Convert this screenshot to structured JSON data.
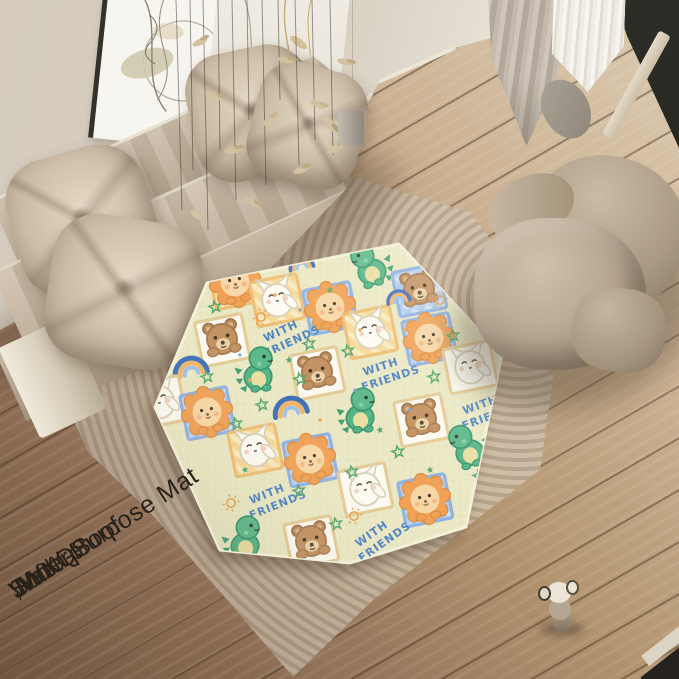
{
  "watermark": {
    "lines": [
      "JWXQS",
      ",Multi-Purpose Mat",
      "Soft",
      "Waterproof"
    ],
    "color": "#29221a"
  },
  "mat": {
    "pattern_text": [
      "WITH",
      "FRIENDS"
    ],
    "shape": "hexagon",
    "colors": {
      "background": "#eae8c3",
      "edge_highlight": "#f3f1d8",
      "text_blue": "#4d83c3",
      "lion_mane": "#f0a155",
      "lion_face": "#f8d7a6",
      "bear_brown": "#c29161",
      "cat_white": "#fdfbf2",
      "dino_green": "#55b385",
      "frame_tan": "#f6d998",
      "frame_blue": "#b9d1ef",
      "star_green": "#58a96e",
      "sun_orange": "#e89a4e"
    },
    "tiles": [
      {
        "t": "lion",
        "f": "tan",
        "x": 235,
        "y": 282
      },
      {
        "t": "cat",
        "f": "tan",
        "x": 277,
        "y": 299
      },
      {
        "t": "lion",
        "f": "blue",
        "x": 330,
        "y": 307
      },
      {
        "t": "dino",
        "x": 368,
        "y": 265,
        "fl": 1
      },
      {
        "t": "bear",
        "f": "blue",
        "x": 419,
        "y": 289
      },
      {
        "t": "bear",
        "f": "white",
        "x": 222,
        "y": 339
      },
      {
        "t": "wf",
        "x": 284,
        "y": 338,
        "r": -25
      },
      {
        "t": "cat",
        "f": "tan",
        "x": 370,
        "y": 331
      },
      {
        "t": "lion",
        "f": "blue",
        "x": 429,
        "y": 338
      },
      {
        "t": "rainbow",
        "x": 301,
        "y": 263,
        "s": 0.9
      },
      {
        "t": "rainbow",
        "x": 190,
        "y": 367
      },
      {
        "t": "dino",
        "x": 259,
        "y": 369
      },
      {
        "t": "bear",
        "f": "white",
        "x": 317,
        "y": 372
      },
      {
        "t": "wf",
        "x": 383,
        "y": 374,
        "r": -18
      },
      {
        "t": "cat",
        "f": "white",
        "x": 470,
        "y": 366
      },
      {
        "t": "rainbow",
        "x": 398,
        "y": 297,
        "s": 0.85
      },
      {
        "t": "cat",
        "f": "white",
        "x": 159,
        "y": 401
      },
      {
        "t": "lion",
        "f": "blue",
        "x": 207,
        "y": 412
      },
      {
        "t": "rainbow",
        "x": 290,
        "y": 407
      },
      {
        "t": "dino",
        "x": 361,
        "y": 410
      },
      {
        "t": "bear",
        "f": "white",
        "x": 421,
        "y": 419
      },
      {
        "t": "wf",
        "x": 483,
        "y": 412,
        "r": -20
      },
      {
        "t": "cat",
        "f": "tan",
        "x": 255,
        "y": 449
      },
      {
        "t": "lion",
        "f": "blue",
        "x": 310,
        "y": 459
      },
      {
        "t": "cat",
        "f": "white",
        "x": 365,
        "y": 488
      },
      {
        "t": "lion",
        "f": "blue",
        "x": 425,
        "y": 499
      },
      {
        "t": "dino",
        "x": 466,
        "y": 446,
        "fl": 1
      },
      {
        "t": "wf",
        "x": 270,
        "y": 501,
        "r": -22
      },
      {
        "t": "dino",
        "x": 246,
        "y": 538
      },
      {
        "t": "bear",
        "f": "white",
        "x": 311,
        "y": 541
      },
      {
        "t": "wf",
        "x": 376,
        "y": 540,
        "r": -35
      }
    ],
    "sprinkles": [
      {
        "t": "star",
        "x": 256,
        "y": 252
      },
      {
        "t": "star",
        "x": 215,
        "y": 307
      },
      {
        "t": "star",
        "x": 309,
        "y": 344
      },
      {
        "t": "star",
        "x": 348,
        "y": 351
      },
      {
        "t": "star",
        "x": 300,
        "y": 379
      },
      {
        "t": "star",
        "x": 207,
        "y": 377
      },
      {
        "t": "star",
        "x": 236,
        "y": 424
      },
      {
        "t": "star",
        "x": 352,
        "y": 472
      },
      {
        "t": "star",
        "x": 299,
        "y": 491
      },
      {
        "t": "star",
        "x": 434,
        "y": 377
      },
      {
        "t": "star",
        "x": 453,
        "y": 336
      },
      {
        "t": "star",
        "x": 479,
        "y": 476
      },
      {
        "t": "star",
        "x": 336,
        "y": 524
      },
      {
        "t": "star",
        "x": 398,
        "y": 452
      },
      {
        "t": "star",
        "x": 262,
        "y": 405
      },
      {
        "t": "sun",
        "x": 261,
        "y": 317
      },
      {
        "t": "sun",
        "x": 231,
        "y": 503
      },
      {
        "t": "sun",
        "x": 354,
        "y": 516
      },
      {
        "t": "sun",
        "x": 440,
        "y": 300
      },
      {
        "t": "starf",
        "x": 289,
        "y": 360
      },
      {
        "t": "starf",
        "x": 245,
        "y": 470
      },
      {
        "t": "starf",
        "x": 380,
        "y": 430
      },
      {
        "t": "starf",
        "x": 330,
        "y": 290
      },
      {
        "t": "starf",
        "x": 430,
        "y": 470
      },
      {
        "t": "dotO",
        "x": 250,
        "y": 380
      },
      {
        "t": "dotO",
        "x": 320,
        "y": 420
      },
      {
        "t": "dotO",
        "x": 275,
        "y": 295
      },
      {
        "t": "dotO",
        "x": 405,
        "y": 330
      },
      {
        "t": "dotO",
        "x": 360,
        "y": 330
      },
      {
        "t": "dotB",
        "x": 300,
        "y": 310
      },
      {
        "t": "dotB",
        "x": 355,
        "y": 390
      },
      {
        "t": "dotB",
        "x": 240,
        "y": 355
      },
      {
        "t": "dotB",
        "x": 410,
        "y": 410
      }
    ]
  },
  "scene": {
    "objects": [
      "beige-sofa",
      "throw-pillows",
      "ribbed-area-rug",
      "play-mat",
      "pouf-lounge-chair",
      "wall-art",
      "hanging-dried-leaves",
      "gray-curtain",
      "sheer-curtain",
      "window-frame",
      "wood-floor",
      "small-toy-figurine"
    ],
    "colors": {
      "wall": "#d8cfc2",
      "sofa": "#c4b4a0",
      "rug": "#c3b19a",
      "floor_light": "#dcccb2",
      "floor_dark": "#71543d",
      "chair": "#b3a28d",
      "window_frame": "#23251f",
      "greenery": "#647546"
    }
  }
}
